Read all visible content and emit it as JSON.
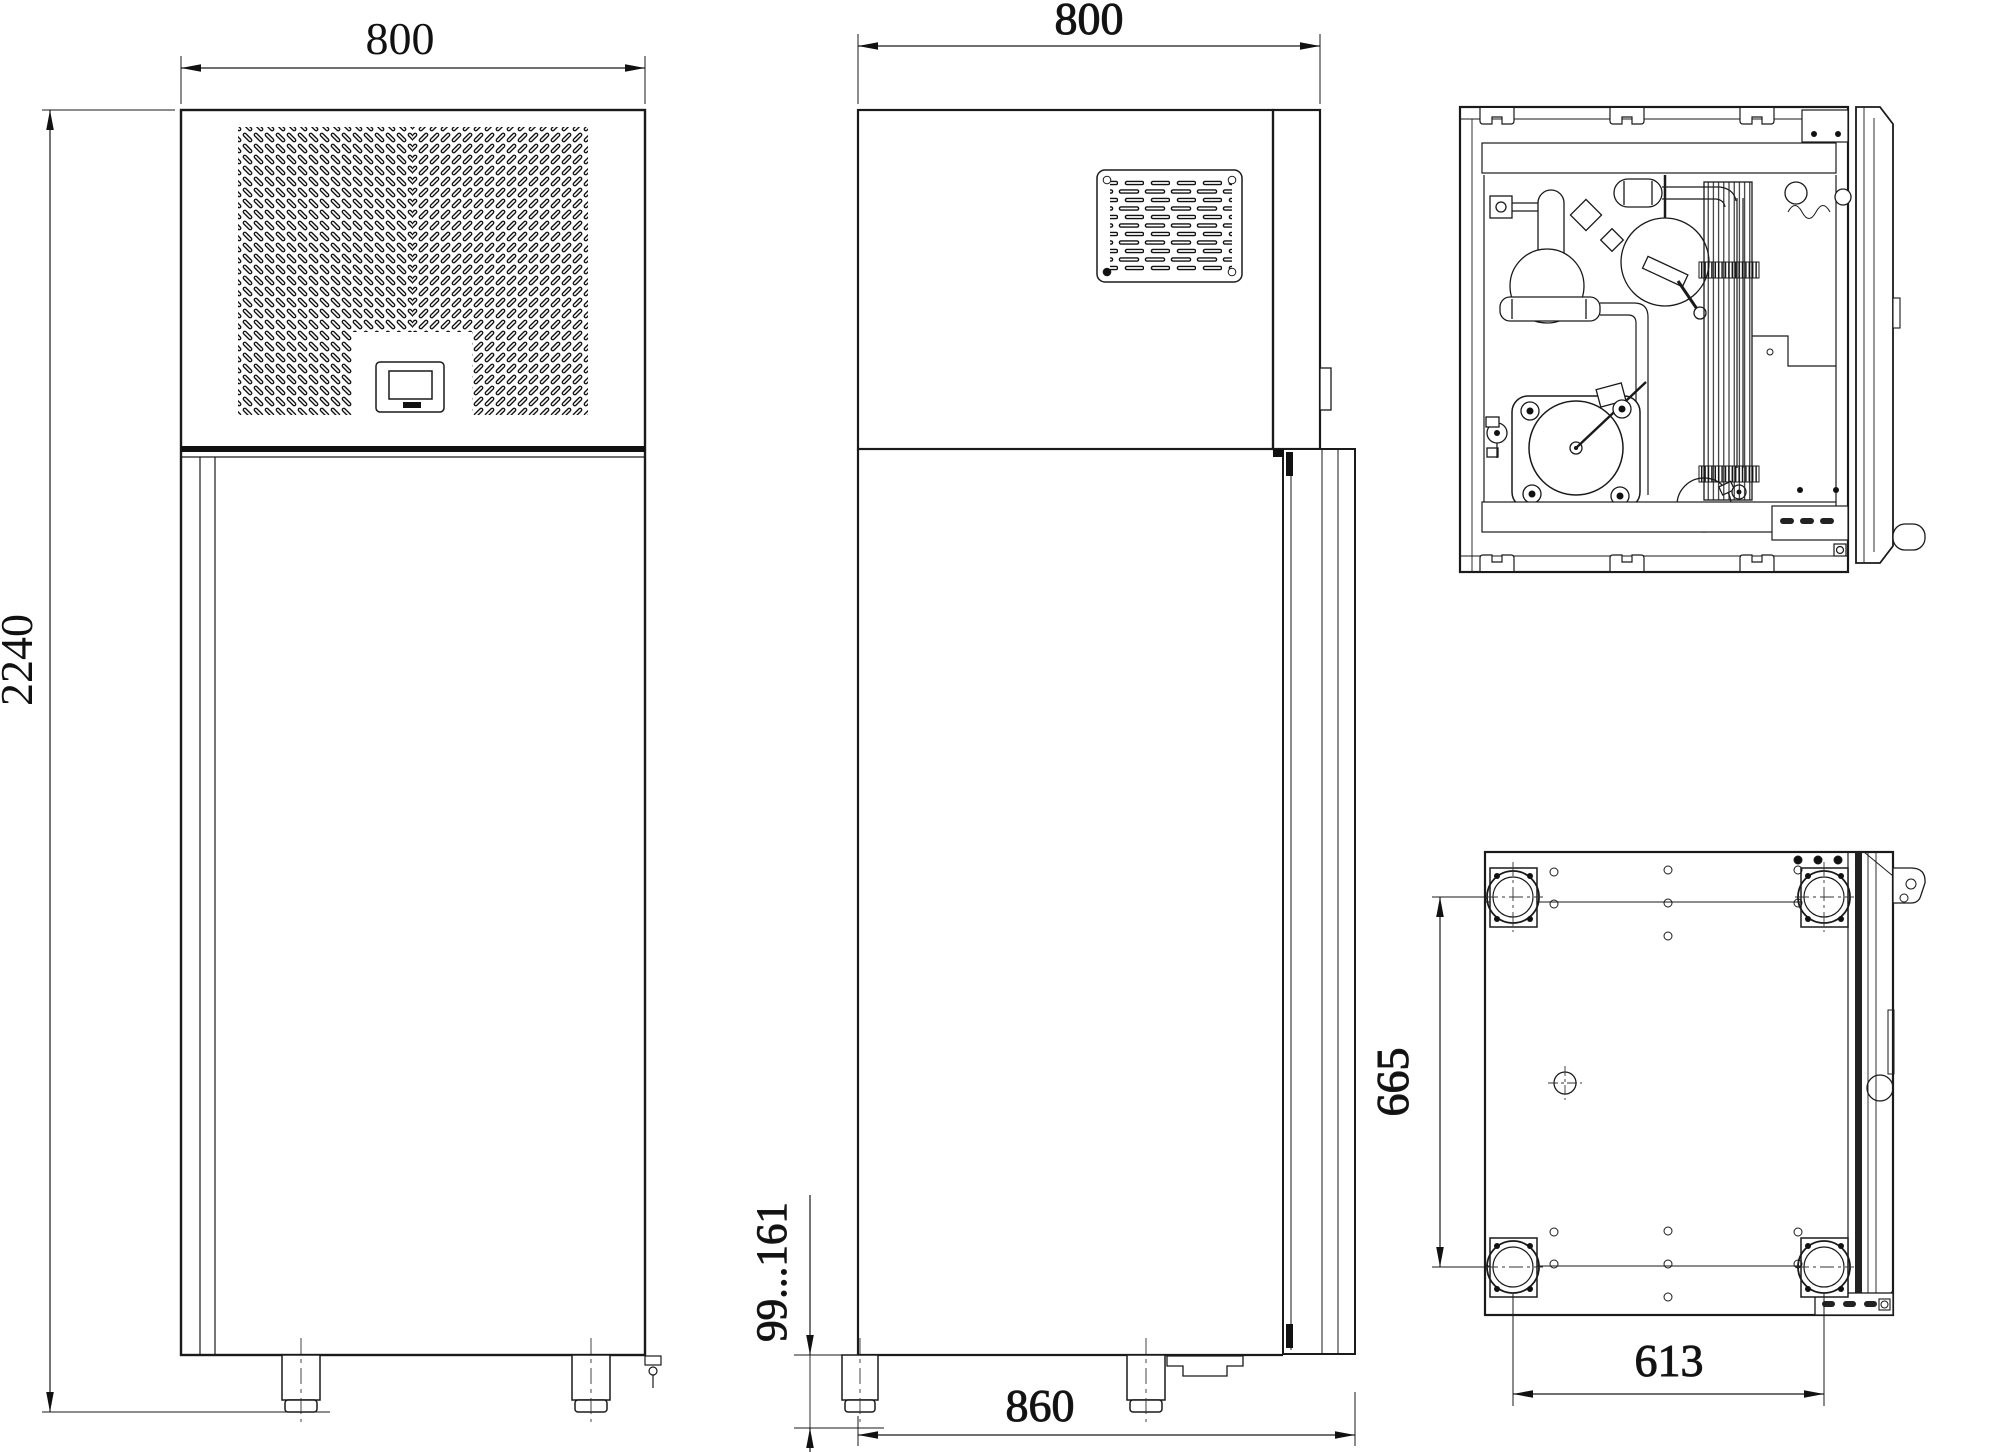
{
  "drawing": {
    "type": "technical-drawing-refrigerated-cabinet",
    "background": "#ffffff",
    "line_color": "#1a1a1a",
    "views": {
      "front": {
        "name": "front view",
        "dim_width_mm": "800",
        "dim_height_mm": "2240"
      },
      "side": {
        "name": "side view",
        "dim_depth_mm": "800",
        "dim_total_depth_mm": "860",
        "dim_foot_height_mm": "99...161"
      },
      "top": {
        "name": "top view (machinery compartment)"
      },
      "bottom": {
        "name": "bottom view",
        "dim_foot_spacing_depth_mm": "665",
        "dim_foot_spacing_width_mm": "613"
      }
    }
  }
}
